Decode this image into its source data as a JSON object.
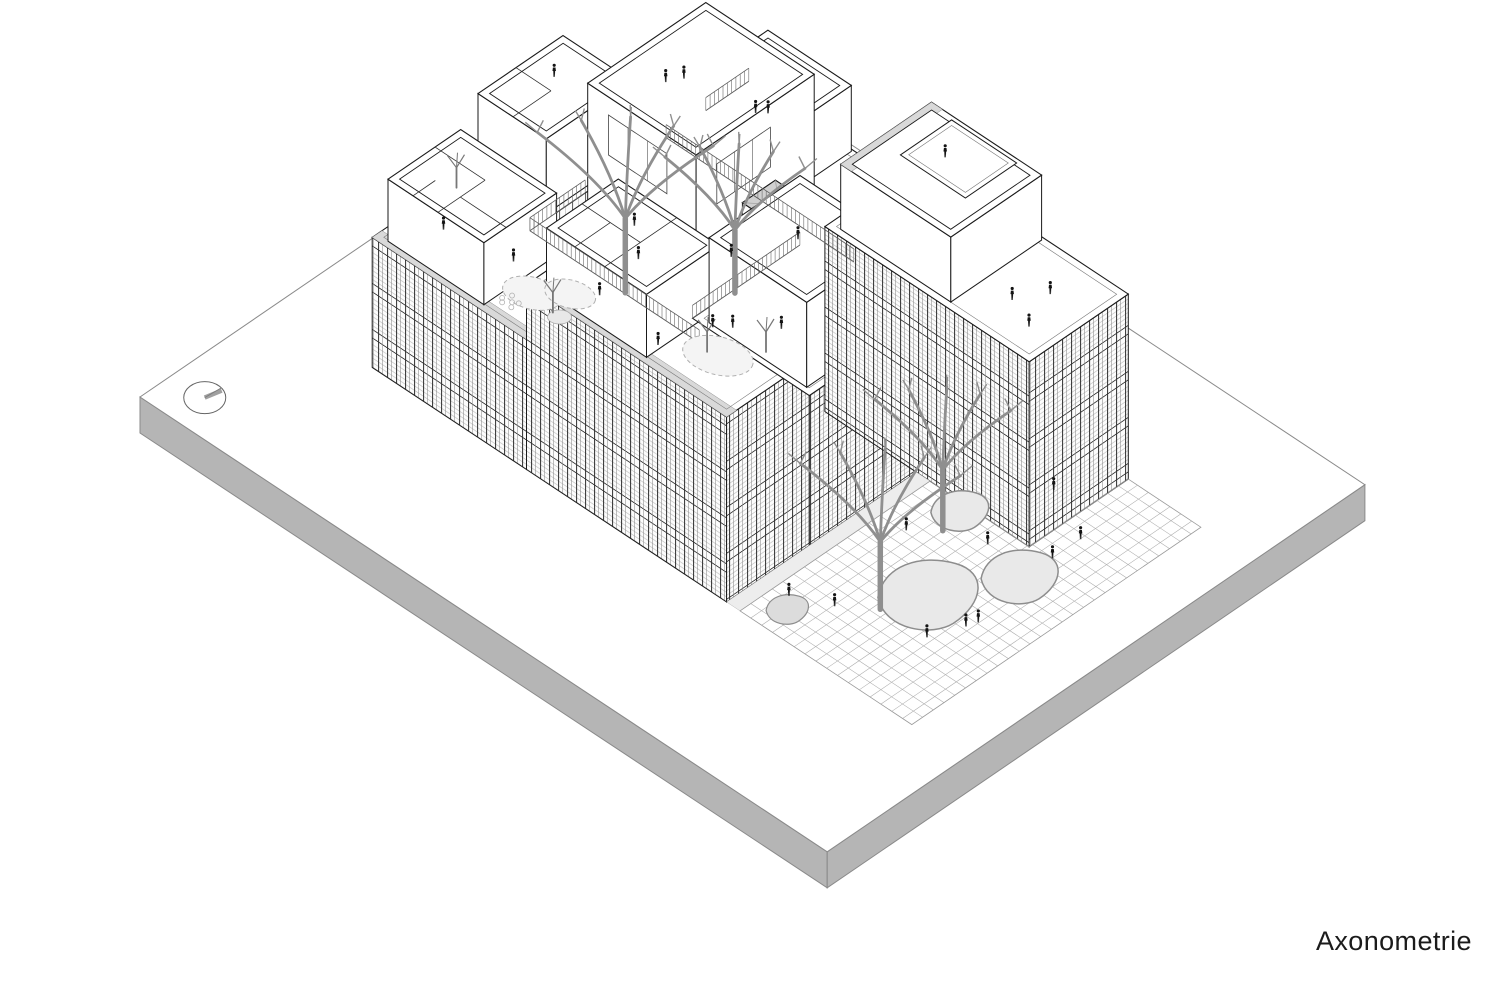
{
  "label": {
    "text": "Axonometrie"
  },
  "colors": {
    "line": "#1a1a1a",
    "plate_side": "#b5b5b5",
    "plate_edge": "#8a8a8a",
    "roof_band": "#d9d9d9",
    "blob_fill": "#e9e9e9",
    "blob_stroke": "#8d8d8d",
    "tree": "#8f8f8f",
    "grid": "#ababab",
    "fence": "#5a5a5a"
  },
  "projection": {
    "origin": [
      140,
      397
    ],
    "eA": [
      0.826,
      -0.564
    ],
    "eB": [
      0.834,
      0.552
    ]
  },
  "plate": {
    "A": 651,
    "B": 824,
    "thickness": 36
  },
  "compass": {
    "a": 38,
    "b": 40,
    "rx": 21,
    "ry": 16,
    "tick": [
      17,
      -7
    ]
  },
  "volumes_back": [
    {
      "name": "back-bar",
      "a": [
        265,
        530
      ],
      "b": [
        115,
        205
      ],
      "h": [
        0,
        130
      ],
      "sw": "light",
      "se": "light",
      "roof": "parapet",
      "roofBand": "sw"
    },
    {
      "name": "pavilion-back-left",
      "a": [
        290,
        393
      ],
      "b": [
        118,
        200
      ],
      "h": [
        130,
        205
      ],
      "sw": "plain",
      "se": "plain",
      "roof": "open",
      "partitions": [
        [
          [
            290,
            160
          ],
          [
            336,
            160
          ]
        ],
        [
          [
            336,
            118
          ],
          [
            336,
            160
          ]
        ]
      ]
    },
    {
      "name": "ne-bar",
      "a": [
        430,
        530
      ],
      "b": [
        205,
        430
      ],
      "h": [
        0,
        130
      ],
      "sw": "light",
      "se": "light",
      "roof": "parapet",
      "roofBand": "sw"
    },
    {
      "name": "pavilion-ne",
      "a": [
        468,
        528
      ],
      "b": [
        230,
        330
      ],
      "h": [
        130,
        196
      ],
      "sw": "plain",
      "se": "plain",
      "roof": "open"
    }
  ],
  "courtyard": {
    "a": [
      265,
      430
    ],
    "b": [
      205,
      408
    ],
    "h": 70,
    "blobs": [
      {
        "c": [
          335,
          300
        ],
        "s": 60
      },
      {
        "c": [
          395,
          370
        ],
        "s": 28
      }
    ],
    "ramps": [
      {
        "from": [
          285,
          240
        ],
        "ctrl": [
          295,
          320
        ],
        "to": [
          360,
          330
        ],
        "w": 7,
        "col": "#9e9e9e"
      },
      {
        "from": [
          280,
          232
        ],
        "ctrl": [
          290,
          312
        ],
        "to": [
          358,
          322
        ],
        "w": 2,
        "col": "#777777"
      },
      {
        "from": [
          360,
          330
        ],
        "ctrl": [
          400,
          345
        ],
        "to": [
          420,
          300
        ],
        "w": 5,
        "col": "#aaaaaa"
      }
    ]
  },
  "volumes_mid": [
    {
      "name": "hall-box",
      "a": [
        335,
        478
      ],
      "b": [
        205,
        335
      ],
      "h": [
        70,
        238
      ],
      "sw": "plain",
      "se": "plain",
      "roof": "open",
      "windows": [
        {
          "face": "sw",
          "u": [
            230,
            300
          ],
          "v": [
            110,
            150
          ],
          "m": 3
        },
        {
          "face": "se",
          "u": [
            360,
            425
          ],
          "v": [
            105,
            145
          ],
          "m": 3
        }
      ]
    },
    {
      "name": "stair-tower",
      "a": [
        388,
        428
      ],
      "b": [
        338,
        386
      ],
      "h": [
        70,
        162
      ],
      "sw": "plain",
      "se": "plain",
      "roof": "grayx"
    }
  ],
  "volumes_front": [
    {
      "name": "west-bar-low",
      "a": [
        165,
        265
      ],
      "b": [
        115,
        300
      ],
      "h": [
        0,
        130
      ],
      "sw": "striped",
      "se": null,
      "roof": "parapet",
      "roofBand": "sw"
    },
    {
      "name": "pavilion-west",
      "a": [
        171,
        259
      ],
      "b": [
        128,
        243
      ],
      "h": [
        130,
        192
      ],
      "sw": "plain",
      "se": "plain",
      "roof": "open",
      "partitions": [
        [
          [
            171,
            188
          ],
          [
            228,
            188
          ]
        ],
        [
          [
            228,
            128
          ],
          [
            228,
            188
          ]
        ],
        [
          [
            198,
            188
          ],
          [
            198,
            243
          ]
        ],
        [
          [
            171,
            158
          ],
          [
            198,
            158
          ]
        ]
      ]
    },
    {
      "name": "west-bar-high",
      "a": [
        165,
        265
      ],
      "b": [
        300,
        540
      ],
      "h": [
        0,
        185
      ],
      "sw": "striped",
      "se": "striped",
      "roof": "parapet",
      "roofBand": "sw"
    },
    {
      "name": "pavilion-mid",
      "a": [
        171,
        258
      ],
      "b": [
        318,
        438
      ],
      "h": [
        185,
        248
      ],
      "sw": "plain",
      "se": "plain",
      "roof": "open",
      "partitions": [
        [
          [
            171,
            388
          ],
          [
            258,
            388
          ]
        ],
        [
          [
            214,
            318
          ],
          [
            214,
            388
          ]
        ],
        [
          [
            171,
            352
          ],
          [
            214,
            352
          ]
        ]
      ]
    },
    {
      "name": "mid-block",
      "a": [
        265,
        395
      ],
      "b": [
        400,
        540
      ],
      "h": [
        0,
        150
      ],
      "sw": null,
      "se": "striped",
      "roof": "parapet"
    },
    {
      "name": "front-box",
      "a": [
        271,
        381
      ],
      "b": [
        414,
        531
      ],
      "h": [
        150,
        235
      ],
      "sw": "plain",
      "se": "plain",
      "roof": "open",
      "windows": [
        {
          "face": "se",
          "u": [
            300,
            348
          ],
          "v": [
            45,
            78
          ],
          "m": 2
        }
      ]
    },
    {
      "name": "east-building",
      "a": [
        395,
        515
      ],
      "b": [
        430,
        675
      ],
      "h": [
        0,
        185
      ],
      "sw": "striped",
      "se": "striped",
      "roof": "parapet"
    },
    {
      "name": "pavilion-east",
      "a": [
        402,
        512
      ],
      "b": [
        442,
        574
      ],
      "h": [
        185,
        250
      ],
      "sw": "plain",
      "se": "plain",
      "roof": "open",
      "roofBand": "nw",
      "inner": {
        "a": [
          446,
          508
        ],
        "b": [
          470,
          548
        ]
      }
    }
  ],
  "fences": [
    {
      "from": [
        265,
        205
      ],
      "to": [
        332,
        205
      ],
      "h": 130
    },
    {
      "from": [
        265,
        205
      ],
      "to": [
        265,
        408
      ],
      "h": 130
    },
    {
      "from": [
        430,
        205
      ],
      "to": [
        430,
        430
      ],
      "h": 130
    },
    {
      "from": [
        265,
        400
      ],
      "to": [
        395,
        400
      ],
      "h": 150
    },
    {
      "from": [
        478,
        205
      ],
      "to": [
        530,
        205
      ],
      "h": 130
    }
  ],
  "terrace_deco": {
    "dashed": [
      {
        "c": [
          210,
          262,
          130
        ],
        "rx": 30,
        "ry": 16
      },
      {
        "c": [
          232,
          286,
          130
        ],
        "rx": 26,
        "ry": 14
      },
      {
        "c": [
          215,
          480,
          185
        ],
        "rx": 36,
        "ry": 19
      }
    ],
    "pebbles": [
      [
        184,
        252,
        130
      ],
      [
        190,
        258,
        130
      ],
      [
        185,
        262,
        130
      ],
      [
        196,
        252,
        130
      ],
      [
        193,
        263,
        130
      ],
      [
        188,
        248,
        130
      ]
    ],
    "solid": {
      "c": [
        205,
        300,
        130
      ],
      "rx": 12,
      "ry": 7
    }
  },
  "small_trees": [
    [
      205,
      292,
      130
    ],
    [
      212,
      470,
      185
    ],
    [
      247,
      506,
      185
    ],
    [
      260,
      122,
      130
    ]
  ],
  "court_trees": [
    {
      "a": 320,
      "b": 265,
      "hb": 70,
      "H": 165,
      "spread": 88
    },
    {
      "a": 385,
      "b": 332,
      "hb": 70,
      "H": 140,
      "spread": 70
    }
  ],
  "plaza": {
    "poly": [
      [
        165,
        556
      ],
      [
        395,
        556
      ],
      [
        395,
        675
      ],
      [
        515,
        675
      ],
      [
        515,
        762
      ],
      [
        165,
        762
      ]
    ],
    "grid_step": 13,
    "sidewalk": [
      [
        165,
        540
      ],
      [
        395,
        540
      ],
      [
        395,
        556
      ],
      [
        165,
        556
      ]
    ],
    "blobs": [
      {
        "c": [
          295,
          655
        ],
        "s": 52
      },
      {
        "c": [
          365,
          695
        ],
        "s": 40
      },
      {
        "c": [
          388,
          600
        ],
        "s": 30
      }
    ],
    "wedge": {
      "c": [
        196,
        583
      ],
      "s": 22
    },
    "trees": [
      {
        "a": 250,
        "b": 640,
        "hb": 0,
        "H": 150,
        "spread": 80
      },
      {
        "a": 358,
        "b": 608,
        "hb": 0,
        "H": 135,
        "spread": 68
      }
    ]
  },
  "figures": [
    [
      225,
      610,
      0
    ],
    [
      285,
      708,
      0
    ],
    [
      296,
      712,
      0
    ],
    [
      252,
      694,
      0
    ],
    [
      336,
      586,
      0
    ],
    [
      372,
      648,
      0
    ],
    [
      398,
      700,
      0
    ],
    [
      207,
      573,
      0
    ],
    [
      432,
      700,
      0
    ],
    [
      460,
      640,
      0
    ],
    [
      302,
      252,
      70
    ],
    [
      352,
      362,
      70
    ],
    [
      415,
      298,
      70
    ],
    [
      292,
      332,
      70
    ],
    [
      214,
      152,
      130
    ],
    [
      227,
      223,
      130
    ],
    [
      254,
      346,
      185
    ],
    [
      237,
      452,
      185
    ],
    [
      308,
      464,
      150
    ],
    [
      382,
      252,
      238
    ],
    [
      396,
      260,
      238
    ],
    [
      350,
      150,
      205
    ],
    [
      440,
      610,
      185
    ],
    [
      468,
      628,
      185
    ],
    [
      426,
      644,
      185
    ],
    [
      470,
      500,
      250
    ],
    [
      505,
      238,
      130
    ],
    [
      512,
      246,
      130
    ],
    [
      225,
      370,
      248
    ],
    [
      322,
      470,
      235
    ]
  ]
}
